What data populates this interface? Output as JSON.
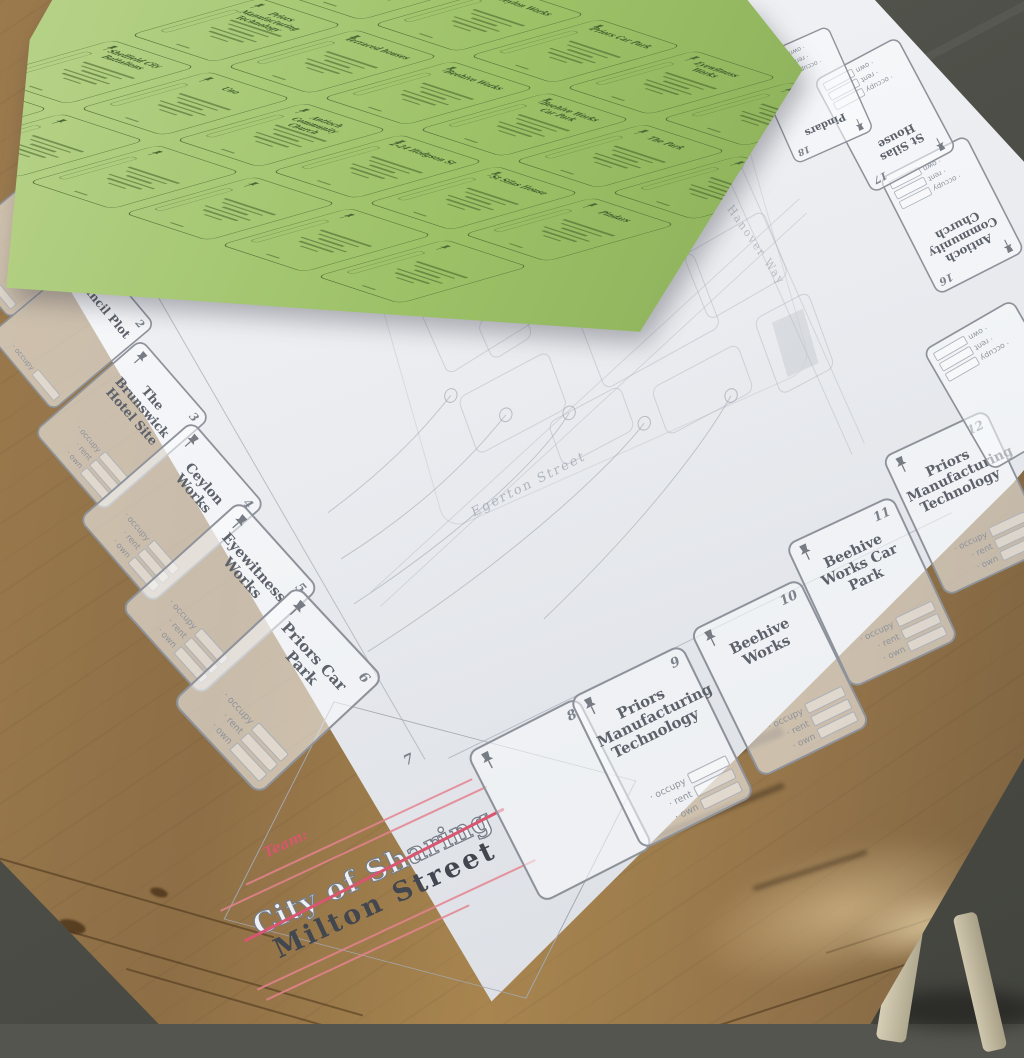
{
  "scene": {
    "description": "Photograph of a City of Sharing board game (Milton Street edition) lying on a wooden table with a green sheet of property cards on top",
    "board_paper_color": "#edeff3",
    "sheet_color": "#9cc167",
    "wood_color": "#96754a",
    "accent_red": "#d8566f",
    "line_gray": "#8e939b"
  },
  "logo": {
    "crossed_out_title": "City of Sharing",
    "title": "Milton Street",
    "handwritten_label": "Team:"
  },
  "board": {
    "corner_numbers": {
      "top_left": "32",
      "bottom": "7"
    },
    "deed_labels": [
      "· occupy",
      "· rent",
      "· own"
    ],
    "left_spaces": [
      {
        "number": "1",
        "title": "Christ Church Central",
        "deeds": 1
      },
      {
        "number": "2",
        "title": "Council Plot",
        "deeds": 1
      },
      {
        "number": "3",
        "title": "The Brunswick Hotel Site",
        "deeds": 3
      },
      {
        "number": "4",
        "title": "Ceylon Works",
        "deeds": 3
      },
      {
        "number": "5",
        "title": "Eyewitness Works",
        "deeds": 3
      },
      {
        "number": "6",
        "title": "Priors Car Park",
        "deeds": 3
      }
    ],
    "bottom_spaces": [
      {
        "number": "8",
        "title": "",
        "deeds": 0
      },
      {
        "number": "9",
        "title": "Priors Manufacturing Technology",
        "deeds": 3
      },
      {
        "number": "10",
        "title": "Beehive Works",
        "deeds": 3
      },
      {
        "number": "11",
        "title": "Beehive Works Car Park",
        "deeds": 3
      },
      {
        "number": "12",
        "title": "Priors Manufacturing Technology",
        "deeds": 3
      }
    ],
    "right_spaces": [
      {
        "number": "",
        "title": "",
        "deeds": 3
      },
      {
        "number": "16",
        "title": "Antioch Community Church",
        "deeds": 3
      },
      {
        "number": "17",
        "title": "St Silas House",
        "deeds": 3
      },
      {
        "number": "18",
        "title": "Pindars",
        "deeds": 3
      }
    ],
    "street_labels": [
      "Egerton Street",
      "Hanover Way"
    ]
  },
  "sheet": {
    "rows": [
      [
        "",
        "Ceylon Works",
        "Priors Car Park",
        "Eyewitness Works",
        "",
        ""
      ],
      [
        "Priors Manufacturing Technology",
        "Terraced houses",
        "Beehive Works",
        "Beehive Works Car Park",
        "The Park",
        ""
      ],
      [
        "Sheffield City Battalions",
        "Uno",
        "Antioch Community Church",
        "2-24 Hodgson St",
        "St Silas House",
        "Pindars"
      ],
      [
        "",
        "",
        "",
        "",
        "",
        ""
      ]
    ]
  }
}
